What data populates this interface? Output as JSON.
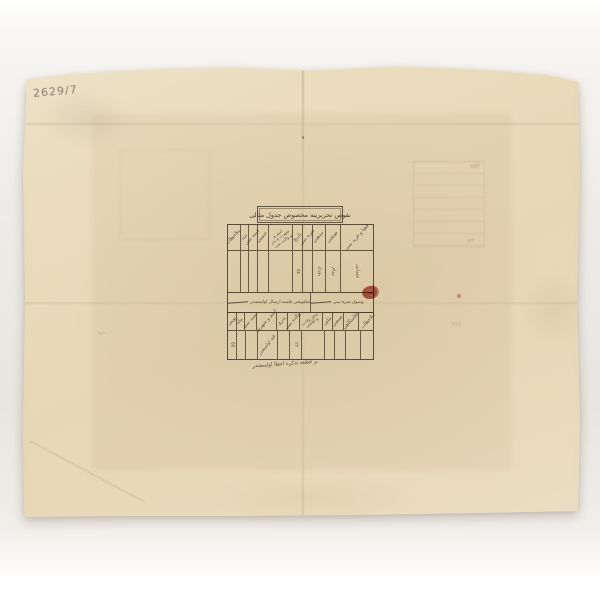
{
  "photo": {
    "backdrop_color": "#edebe7",
    "paper_color": "#e9dabc",
    "ink_color": "#4a3e30",
    "stamp_color": "#b24536",
    "pencil_color": "#6c6258"
  },
  "paper": {
    "pencil_note": "2629/7",
    "faint_note_left": "مىد",
    "faint_note_right": "٣٥٤",
    "ghost_mark_a": "٤٥٣",
    "ghost_mark_b": "حم"
  },
  "table": {
    "title": "نفوس تحريرينه مخصوص جدول مثالى",
    "upper": {
      "headers": [
        "ملاحظات",
        "عدد",
        "قيمه سى",
        "جنسى",
        "اسم و شهرت و پدر و والده سى",
        "تاريخ",
        "نمره سى",
        "مذهبى",
        "صنعتى",
        "قضا و قريه سى"
      ],
      "entries": {
        "e5": "٥٤",
        "e7": "بغداد",
        "e8": "تمام",
        "e9": "عثمانى"
      }
    },
    "band": {
      "left_text": "مكتوبجى قلمنه ارسال اولنمشدر",
      "right_text": "وصول نمره سى",
      "stamp": "وصل"
    },
    "lower": {
      "headers": [
        "يومى",
        "ماه",
        "سنه سى",
        "اسم و شهرتى",
        "پدرى",
        "والده سى",
        "محل ولادت و اقامتى",
        "ملتى",
        "صنعتى",
        "اقامتگاهى",
        "ملاحظات"
      ],
      "entries": {
        "e0": "٥٥",
        "e3": "قيد اولنمشدر",
        "e5": "٢٢"
      }
    },
    "signature": "بر قطعه تذكره اعطا اولنمشدر"
  }
}
